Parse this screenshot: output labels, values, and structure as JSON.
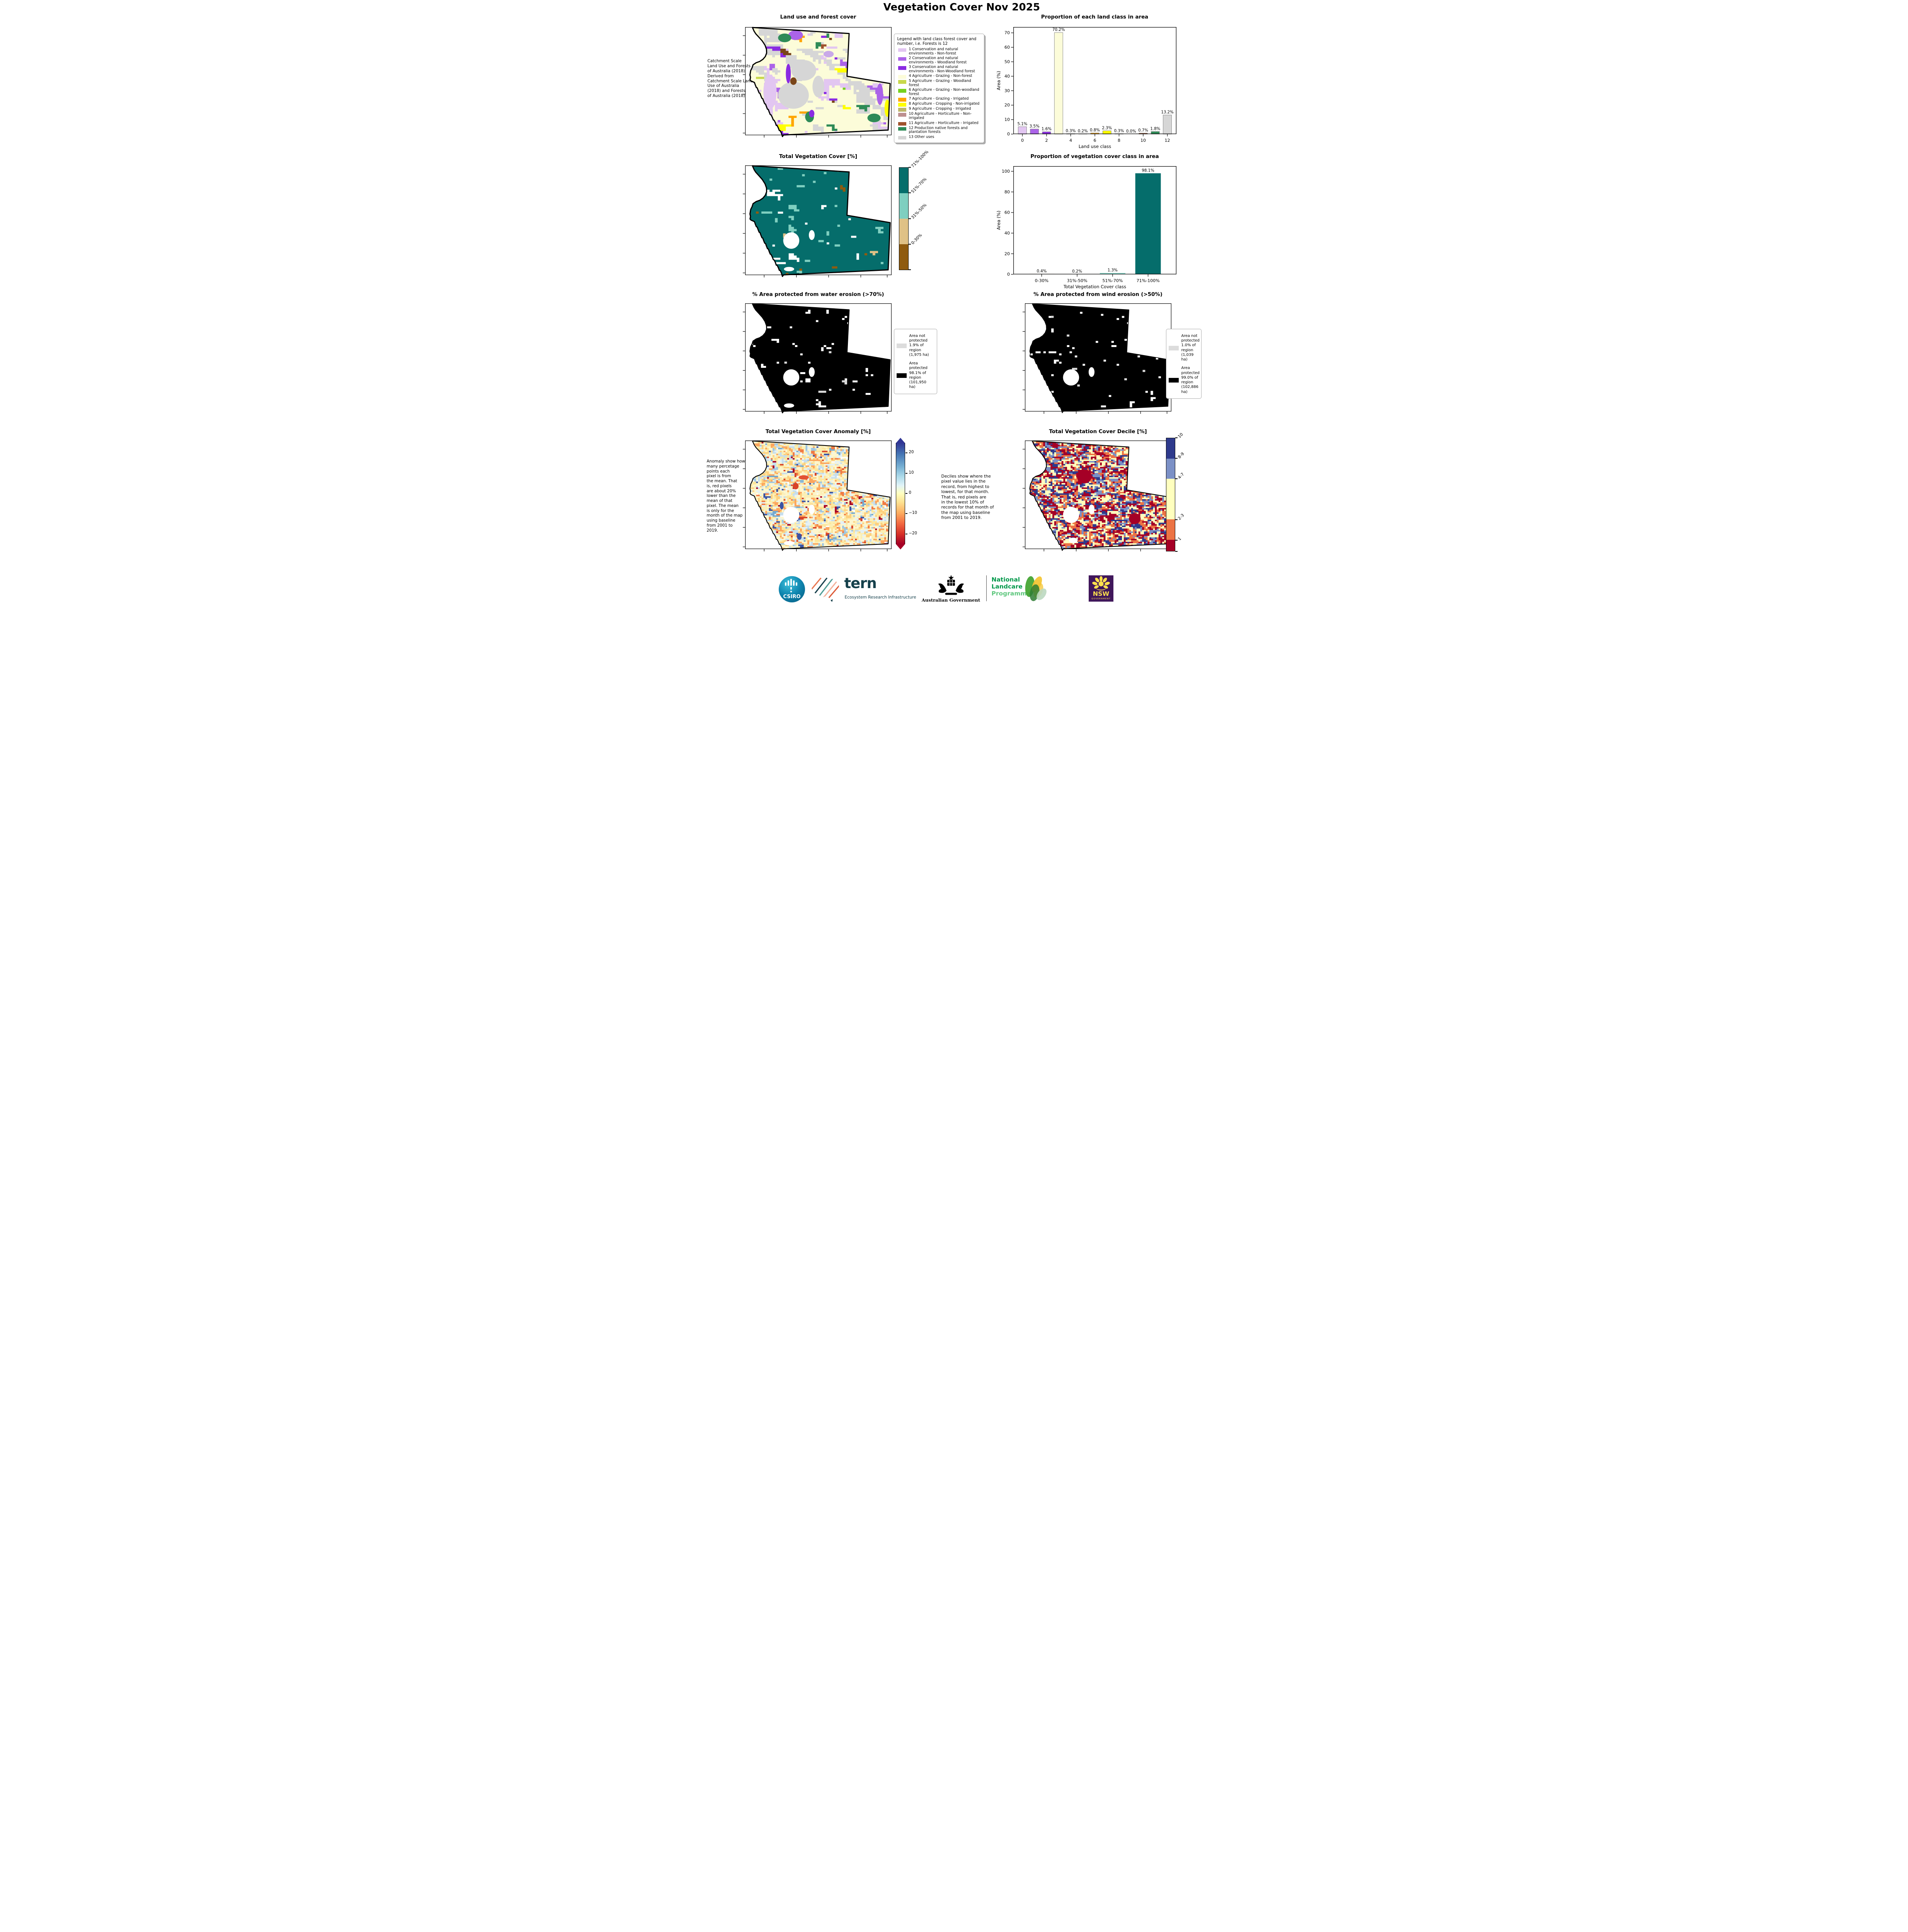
{
  "page_title": "Vegetation Cover Nov 2025",
  "chart_data": [
    {
      "id": "land_class",
      "type": "bar",
      "title": "Proportion of each land class in area",
      "xlabel": "Land use class",
      "ylabel": "Area (%)",
      "ylim": [
        0,
        74
      ],
      "yticks": [
        0,
        10,
        20,
        30,
        40,
        50,
        60,
        70
      ],
      "xticks": [
        0,
        2,
        4,
        6,
        8,
        10,
        12
      ],
      "x": [
        0,
        1,
        2,
        3,
        4,
        5,
        6,
        7,
        8,
        9,
        10,
        11,
        12
      ],
      "values": [
        5.1,
        3.5,
        1.6,
        70.2,
        0.3,
        0.2,
        0.8,
        2.3,
        0.3,
        0.0,
        0.7,
        1.8,
        13.2
      ],
      "bar_labels": [
        "5.1%",
        "3.5%",
        "1.6%",
        "70.2%",
        "0.3%",
        "0.2%",
        "0.8%",
        "2.3%",
        "0.3%",
        "0.0%",
        "0.7%",
        "1.8%",
        "13.2%"
      ],
      "colors": [
        "#E2C6F1",
        "#AB63E8",
        "#8A2BE2",
        "#FCFCD9",
        "#C8D84B",
        "#76D11E",
        "#FFA500",
        "#FFFF00",
        "#BDB76B",
        "#BC8F8F",
        "#A0522D",
        "#2E8B57",
        "#D6D6D6"
      ],
      "edge": "#8a8a8a",
      "pad": 0.75,
      "barw": 0.7,
      "legend_position": "none",
      "grid": "off"
    },
    {
      "id": "veg_class",
      "type": "bar",
      "title": "Proportion of vegetation cover class in area",
      "xlabel": "Total Vegetation Cover class",
      "ylabel": "Area (%)",
      "ylim": [
        0,
        105
      ],
      "yticks": [
        0,
        20,
        40,
        60,
        80,
        100
      ],
      "categories": [
        "0-30%",
        "31%-50%",
        "51%-70%",
        "71%-100%"
      ],
      "values": [
        0.4,
        0.2,
        1.3,
        98.1
      ],
      "bar_labels": [
        "0.4%",
        "0.2%",
        "1.3%",
        "98.1%"
      ],
      "colors": [
        "#8F5B0F",
        "#DFC186",
        "#7FCFC0",
        "#056D6B"
      ],
      "edge": "none",
      "pad": 0.8,
      "barw": 0.72,
      "legend_position": "none",
      "grid": "off"
    }
  ],
  "maps": {
    "landuse": {
      "title": "Land use and forest cover",
      "side_note": "Catchment Scale\nLand Use and Forests\nof Australia (2018)\nDerived from\nCatchment Scale Land\nUse of Australia\n(2018) and Forests\nof Australia (2018)",
      "legend_title": "Legend with land class forest cover and\nnumber, i.e. Forests is 12",
      "legend_items": [
        {
          "label": "1 Conservation and natural environments - Non-forest",
          "color": "#E2C6F1"
        },
        {
          "label": "2 Conservation and natural environments - Woodland forest",
          "color": "#AB63E8"
        },
        {
          "label": "3 Conservation and natural environments - Non-Woodland forest",
          "color": "#8A2BE2"
        },
        {
          "label": "4 Agriculture - Grazing - Non-forest",
          "color": "#FCFCD9"
        },
        {
          "label": "5 Agriculture - Grazing - Woodland forest",
          "color": "#C8D84B"
        },
        {
          "label": "6 Agriculture - Grazing - Non-woodland forest",
          "color": "#76D11E"
        },
        {
          "label": "7 Agriculture - Grazing - Irrigated",
          "color": "#FFA500"
        },
        {
          "label": "8 Agriculture - Cropping - Non-irrigated",
          "color": "#FFFF00"
        },
        {
          "label": "9 Agriculture - Cropping - Irrigated",
          "color": "#BDB76B"
        },
        {
          "label": "10 Agriculture - Horticulture - Non-irrigated",
          "color": "#BC8F8F"
        },
        {
          "label": "11 Agriculture - Horticulture - Irrigated",
          "color": "#A0522D"
        },
        {
          "label": "12 Production native forests and plantation forests",
          "color": "#2E8B57"
        },
        {
          "label": "13 Other uses",
          "color": "#D6D6D6"
        }
      ],
      "noise": {
        "grid": [
          54,
          50
        ],
        "seed": 7,
        "cluster": [
          0.5,
          0.84
        ],
        "outline": 3,
        "palette": [
          [
            "#FCFCD9",
            0.72
          ],
          [
            "#D6D6D6",
            0.115
          ],
          [
            "#E2C6F1",
            0.05
          ],
          [
            "#AB63E8",
            0.03
          ],
          [
            "#8A2BE2",
            0.013
          ],
          [
            "#FFFF00",
            0.02
          ],
          [
            "#FFA500",
            0.009
          ],
          [
            "#2E8B57",
            0.016
          ],
          [
            "#C8D84B",
            0.004
          ],
          [
            "#76D11E",
            0.003
          ],
          [
            "#BDB76B",
            0.004
          ],
          [
            "#BC8F8F",
            0.003
          ],
          [
            "#A0522D",
            0.006
          ],
          [
            "#7A4519",
            0.007
          ]
        ],
        "blobs": [
          [
            0.4,
            0.4,
            0.085,
            0.095,
            "#D6D6D6"
          ],
          [
            0.33,
            0.63,
            0.105,
            0.125,
            "#D6D6D6"
          ],
          [
            0.5,
            0.55,
            0.04,
            0.1,
            "#D6D6D6"
          ],
          [
            0.17,
            0.6,
            0.045,
            0.16,
            "#E2C6F1"
          ],
          [
            0.155,
            0.78,
            0.035,
            0.1,
            "#E2C6F1"
          ],
          [
            0.345,
            0.075,
            0.05,
            0.045,
            "#AB63E8"
          ],
          [
            0.27,
            0.1,
            0.045,
            0.04,
            "#2E8B57"
          ],
          [
            0.295,
            0.43,
            0.017,
            0.09,
            "#8A2BE2"
          ],
          [
            0.33,
            0.5,
            0.022,
            0.035,
            "#7A4519"
          ],
          [
            0.44,
            0.83,
            0.03,
            0.05,
            "#2E8B57"
          ],
          [
            0.455,
            0.8,
            0.018,
            0.035,
            "#8A2BE2"
          ],
          [
            0.88,
            0.84,
            0.045,
            0.04,
            "#2E8B57"
          ],
          [
            0.92,
            0.62,
            0.022,
            0.1,
            "#AB63E8"
          ],
          [
            0.97,
            0.75,
            0.018,
            0.08,
            "#FFFF00"
          ],
          [
            0.57,
            0.25,
            0.035,
            0.03,
            "#C9A9E8"
          ]
        ],
        "holes": []
      }
    },
    "vegcover": {
      "title": "Total Vegetation Cover [%]",
      "colorbar_labels": [
        "71%-100%",
        "51%-70%",
        "31%-50%",
        "0-30%"
      ],
      "colorbar_colors": [
        "#056D6B",
        "#7FCFC0",
        "#DFC186",
        "#8F5B0F"
      ],
      "noise": {
        "grid": [
          54,
          50
        ],
        "seed": 11,
        "cluster": [
          0.35,
          0.6
        ],
        "outline": 3,
        "palette": [
          [
            "#056D6B",
            0.952
          ],
          [
            "#7FCFC0",
            0.022
          ],
          [
            "none",
            0.016
          ],
          [
            "#DFC186",
            0.005
          ],
          [
            "#8F5B0F",
            0.005
          ]
        ],
        "blobs": [
          [
            0.33,
            0.72,
            0.015,
            0.022,
            "#8F5B0F"
          ]
        ],
        "holes": [
          [
            0.315,
            0.685,
            0.055,
            0.075
          ],
          [
            0.455,
            0.635,
            0.02,
            0.045
          ],
          [
            0.3,
            0.945,
            0.035,
            0.02
          ]
        ]
      }
    },
    "water": {
      "title": "% Area protected from water erosion (>70%)",
      "legend_not": "Area not\nprotected\n1.9% of\nregion\n(1,975 ha)",
      "legend_prot": "Area\nprotected\n98.1% of\nregion\n(101,950\nha)",
      "swatch_not": "#DCDCDC",
      "swatch_prot": "#000000",
      "noise": {
        "grid": [
          56,
          52
        ],
        "seed": 23,
        "cluster": [
          0.2,
          0.35
        ],
        "outline": 2.6,
        "palette": [
          [
            "#000000",
            0.96
          ],
          [
            "none",
            0.035
          ],
          [
            "#D9D9D9",
            0.005
          ]
        ],
        "blobs": [],
        "holes": [
          [
            0.315,
            0.685,
            0.055,
            0.075
          ],
          [
            0.455,
            0.635,
            0.02,
            0.045
          ],
          [
            0.3,
            0.945,
            0.035,
            0.02
          ]
        ]
      }
    },
    "wind": {
      "title": "% Area protected from wind erosion (>50%)",
      "legend_not": "Area not\nprotected\n1.0% of\nregion\n(1,039 ha)",
      "legend_prot": "Area\nprotected\n99.0% of\nregion\n(102,886\nha)",
      "swatch_not": "#DCDCDC",
      "swatch_prot": "#000000",
      "noise": {
        "grid": [
          56,
          52
        ],
        "seed": 31,
        "cluster": [
          0.2,
          0.35
        ],
        "outline": 1.6,
        "palette": [
          [
            "#000000",
            0.97
          ],
          [
            "none",
            0.026
          ],
          [
            "#D9D9D9",
            0.004
          ]
        ],
        "blobs": [],
        "holes": [
          [
            0.315,
            0.685,
            0.055,
            0.075
          ],
          [
            0.455,
            0.635,
            0.02,
            0.045
          ]
        ]
      }
    },
    "anomaly": {
      "title": "Total Vegetation Cover Anomaly [%]",
      "side_note": "Anomaly show how\nmany percetage\npoints each\npixel is from\nthe mean. That\nis, red pixels\nare about 20%\nlower than the\nmean of that\npixel. The mean\nis only for the\nmonth of the map\nusing baseline\nfrom 2001 to\n2019.",
      "colorbar_ticks": [
        "20",
        "10",
        "0",
        "−10",
        "−20"
      ],
      "noise": {
        "grid": [
          80,
          74
        ],
        "seed": 41,
        "cluster": [
          0.22,
          0.38
        ],
        "outline": 2.2,
        "palette": [
          [
            "#FDF6CE",
            0.22
          ],
          [
            "#FBEFB5",
            0.12
          ],
          [
            "#FDE69C",
            0.12
          ],
          [
            "#FDD07E",
            0.1
          ],
          [
            "#FCA55D",
            0.063
          ],
          [
            "#F07B44",
            0.035
          ],
          [
            "#D84327",
            0.018
          ],
          [
            "#A50026",
            0.012
          ],
          [
            "#E4F1F6",
            0.1
          ],
          [
            "#C6DEED",
            0.075
          ],
          [
            "#9FC6E0",
            0.042
          ],
          [
            "#74A9CF",
            0.02
          ],
          [
            "#3A53A4",
            0.013
          ],
          [
            "none",
            0.02
          ]
        ],
        "blobs": [
          [
            0.4,
            0.34,
            0.035,
            0.02,
            "#E35233"
          ],
          [
            0.345,
            0.42,
            0.02,
            0.03,
            "#D84327"
          ],
          [
            0.25,
            0.6,
            0.013,
            0.035,
            "#3A53A4"
          ],
          [
            0.37,
            0.885,
            0.016,
            0.03,
            "#3A53A4"
          ]
        ],
        "holes": [
          [
            0.315,
            0.685,
            0.055,
            0.075
          ],
          [
            0.455,
            0.635,
            0.02,
            0.045
          ],
          [
            0.3,
            0.945,
            0.035,
            0.02
          ]
        ]
      }
    },
    "decile": {
      "title": "Total Vegetation Cover Decile [%]",
      "side_note": "Deciles show where the\npixel value lies in the\nrecord, from highest to\nlowest, for that month.\nThat is, red pixels are\nin the lowest 10% of\nrecords for that month of\nthe map using baseline\nfrom 2001 to 2019.",
      "colorbar_labels": [
        "10",
        "8-9",
        "4-7",
        "2-3",
        "1"
      ],
      "colorbar_colors": [
        "#2E3A8C",
        "#7B90C6",
        "#FFFFBE",
        "#EC7344",
        "#A50026"
      ],
      "noise": {
        "grid": [
          80,
          74
        ],
        "seed": 57,
        "cluster": [
          0.25,
          0.42
        ],
        "outline": 2.2,
        "palette": [
          [
            "#A50026",
            0.245
          ],
          [
            "#EC7344",
            0.185
          ],
          [
            "#FFFFBE",
            0.265
          ],
          [
            "#7B90C6",
            0.165
          ],
          [
            "#2E3A8C",
            0.14
          ]
        ],
        "blobs": [
          [
            0.405,
            0.33,
            0.05,
            0.065,
            "#A50026"
          ],
          [
            0.75,
            0.72,
            0.04,
            0.05,
            "#A50026"
          ]
        ],
        "holes": [
          [
            0.315,
            0.685,
            0.055,
            0.075
          ],
          [
            0.455,
            0.635,
            0.02,
            0.045
          ],
          [
            0.33,
            0.92,
            0.03,
            0.025
          ]
        ]
      }
    }
  },
  "footer": {
    "csiro": "CSIRO",
    "tern": "tern",
    "tern_tagline": "Ecosystem Research Infrastructure",
    "aus_gov": "Australian Government",
    "nlp_line1": "National",
    "nlp_line2": "Landcare",
    "nlp_line3": "Programme",
    "nsw": "NSW",
    "nsw_sub": "GOVERNMENT"
  },
  "colors": {
    "accent_teal": "#056D6B",
    "protected_black": "#000000",
    "not_protected_gray": "#DCDCDC",
    "anomaly_top_blue": "#313695",
    "anomaly_bottom_red": "#A50026"
  }
}
